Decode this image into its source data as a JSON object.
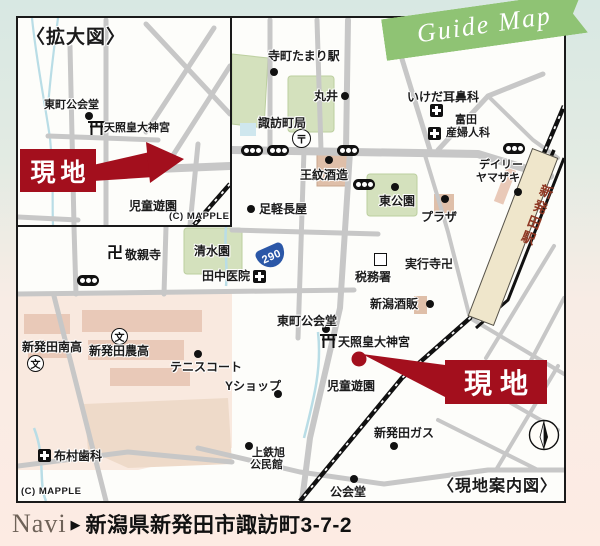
{
  "ribbon": {
    "label": "Guide Map"
  },
  "inset": {
    "title": "〈拡大図〉",
    "site_label": "現地",
    "copyright": "(C) MAPPLE",
    "pois": {
      "higashimachi_kokaido": "東町公会堂",
      "shrine": "天照皇大神宮",
      "jido_yuen": "児童遊園"
    }
  },
  "main_map": {
    "caption": "〈現地案内図〉",
    "copyright": "(C) MAPPLE",
    "compass_north": "N",
    "route_shield": "290",
    "site_label": "現地",
    "station": "新発田駅",
    "symbols": {
      "post": "〒",
      "school": "文",
      "temple": "卍"
    },
    "pois": {
      "teramachi_tamari": "寺町たまり駅",
      "marui": "丸井",
      "ikeda_jibika": "いけだ耳鼻科",
      "tomita_line1": "富田",
      "tomita_line2": "産婦人科",
      "suwacho_post": "諏訪町局",
      "omon_shuzo": "王紋酒造",
      "higashi_koen": "東公園",
      "plaza": "プラザ",
      "ashigaru_nagaya": "足軽長屋",
      "daily_line1": "デイリー",
      "daily_line2": "ヤマザキ",
      "jikkoji": "実行寺卍",
      "zeimusho": "税務署",
      "niigata_shuhan": "新潟酒販",
      "keishinji": "敬親寺",
      "shimizuen": "清水園",
      "tanaka_iin": "田中医院",
      "higashimachi_kokaido": "東町公会堂",
      "shrine": "天照皇大神宮",
      "jido_yuen": "児童遊園",
      "shibata_gas": "新発田ガス",
      "kokaido": "公会堂",
      "kamitetsu_line1": "上鉄旭",
      "kamitetsu_line2": "公民館",
      "yshop": "Yショップ",
      "tennis_court": "テニスコート",
      "shibata_nanko": "新発田南高",
      "shibata_noko": "新発田農高",
      "nunomura_shika": "布村歯科"
    }
  },
  "navi": {
    "prefix": "Navi",
    "arrow": "▶",
    "address": "新潟県新発田市諏訪町3-7-2"
  }
}
